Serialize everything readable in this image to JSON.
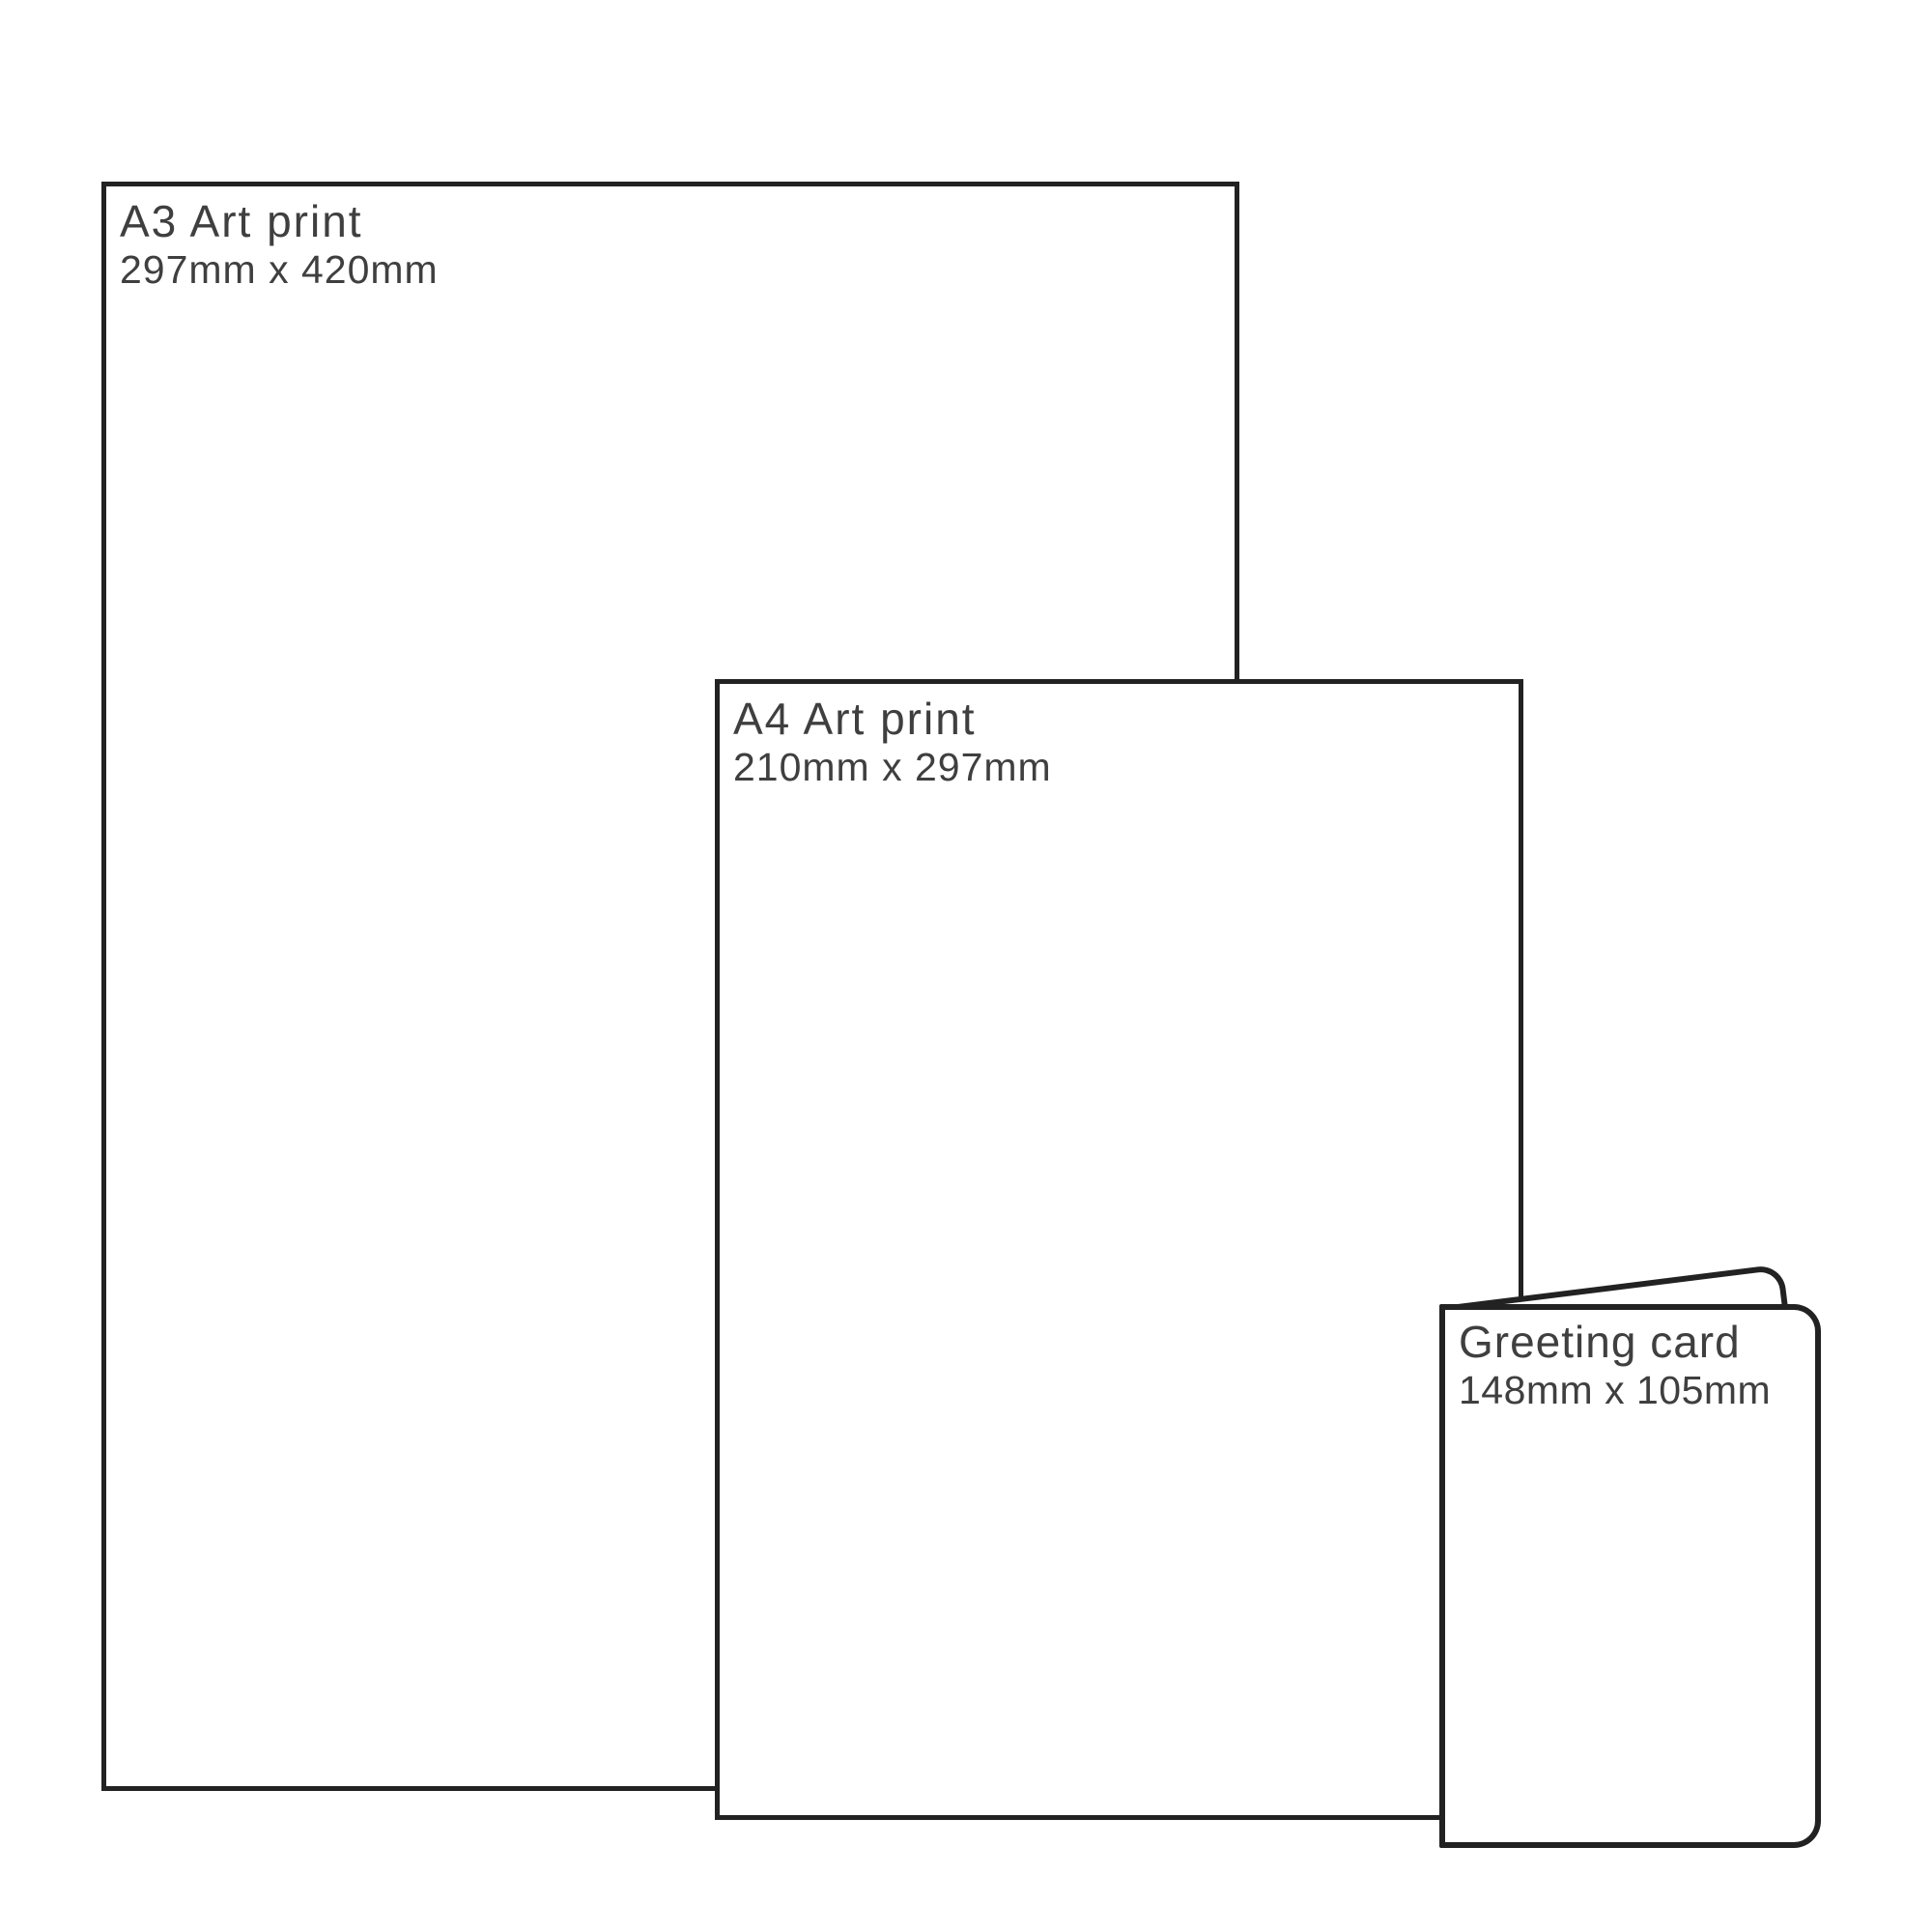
{
  "diagram": {
    "description": "Print size comparison diagram",
    "background_color": "#ffffff",
    "line_color": "#222222",
    "text_color": "#3f3f3f",
    "sheets": [
      {
        "title": "A3 Art print",
        "dimensions": "297mm x 420mm"
      },
      {
        "title": "A4 Art print",
        "dimensions": "210mm x 297mm"
      },
      {
        "title": "Greeting card",
        "dimensions": "148mm x 105mm"
      }
    ]
  }
}
